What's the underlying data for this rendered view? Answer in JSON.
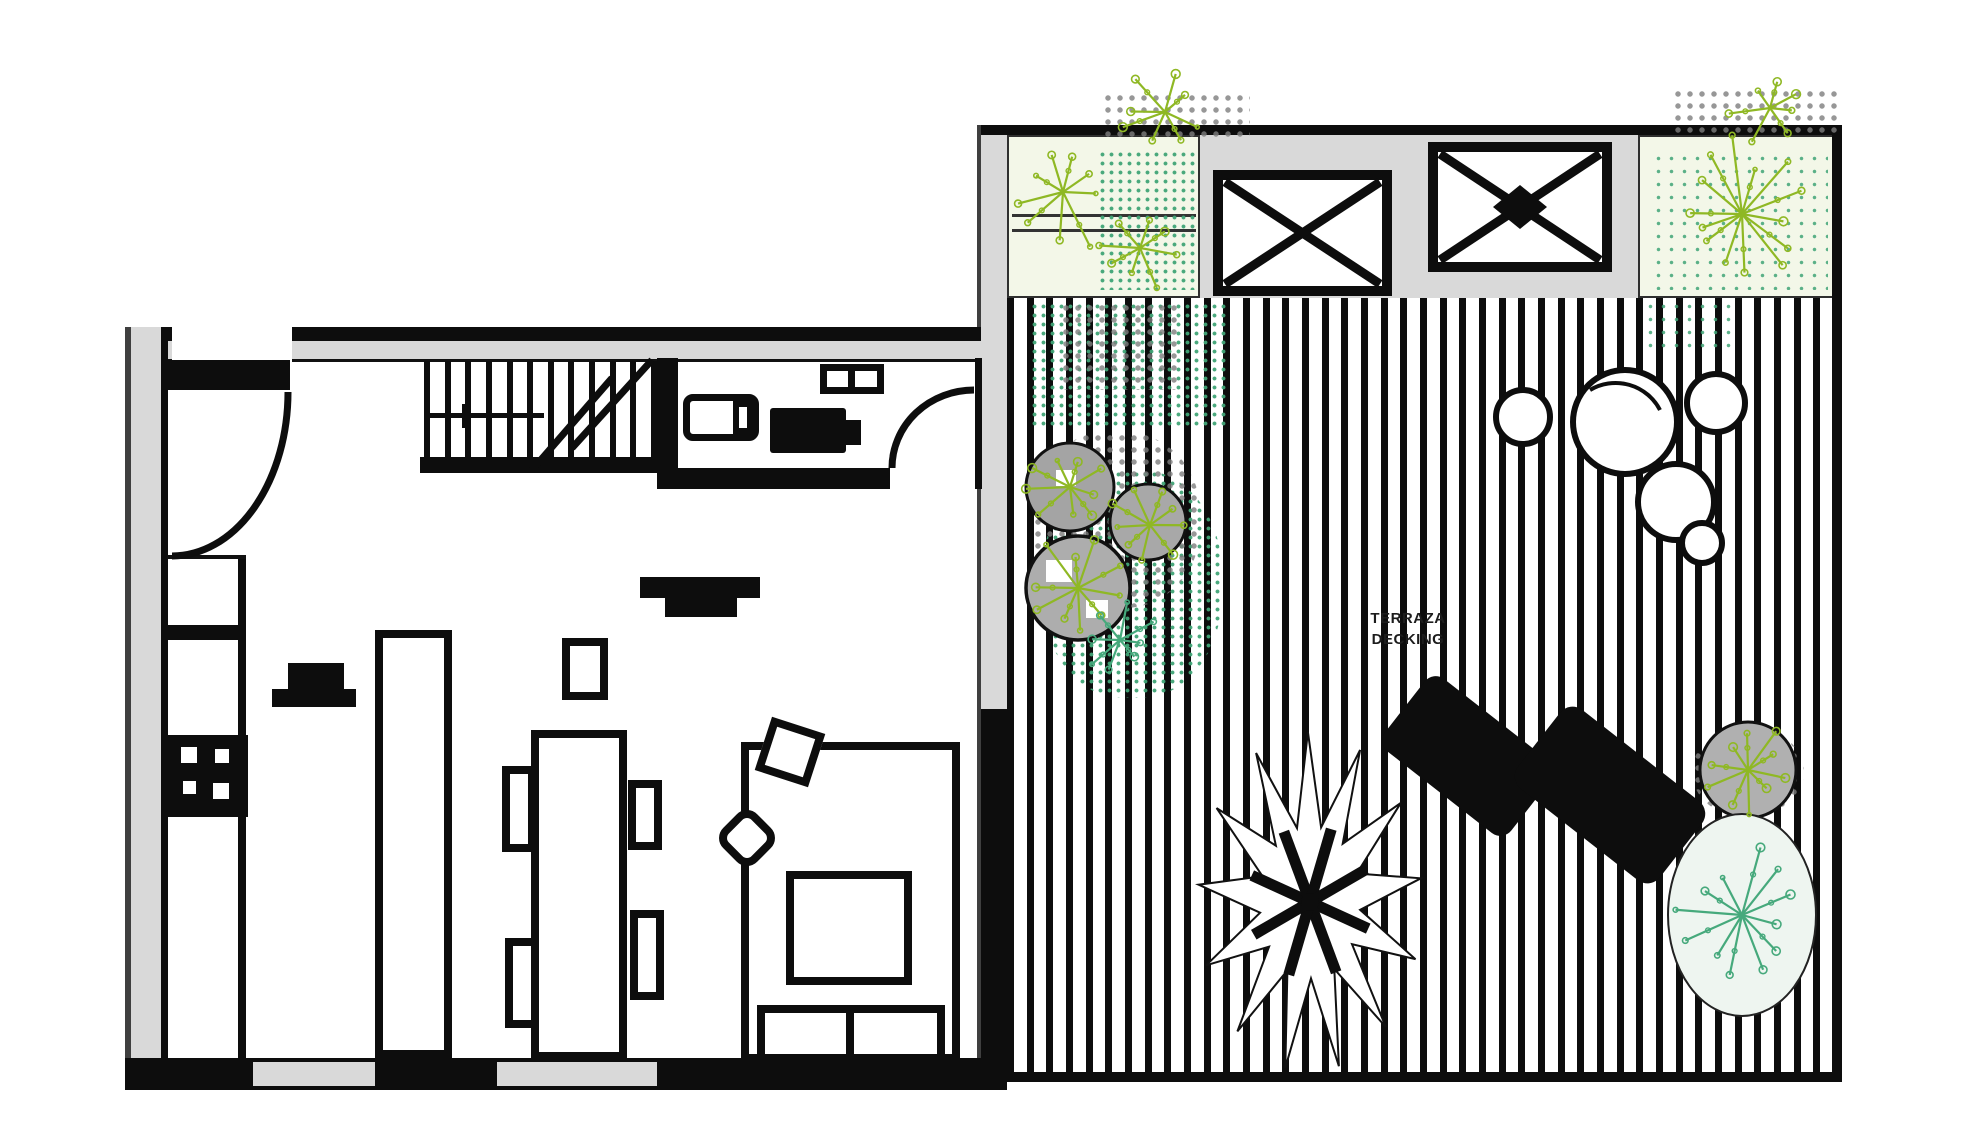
{
  "palette": {
    "ink": "#0d0d0d",
    "wall_gray": "#d9d9d9",
    "planter_bg": "#f3f7e8",
    "leaf_green": "#8fb824",
    "leaf_teal": "#46a97c",
    "shadow_gray": "#ababab"
  },
  "deck": {
    "label": {
      "line1": "TERRAZA",
      "line2": "DECKING"
    },
    "board_count": 43,
    "skylight_count": 2,
    "planter_count": 2,
    "palm": {
      "cx": 1310,
      "cy": 902,
      "points": 13,
      "rx": 112,
      "ry": 170,
      "inner": 0.45,
      "rot": -0.14,
      "spokes": 8,
      "spoke_len": 62
    },
    "stones": [
      [
        1523,
        417,
        27
      ],
      [
        1625,
        422,
        52
      ],
      [
        1716,
        403,
        29
      ],
      [
        1676,
        502,
        38
      ],
      [
        1702,
        543,
        20
      ]
    ],
    "plants": [
      {
        "name": "planter1-fern-a",
        "cx": 1063,
        "cy": 192,
        "r": 62,
        "spokes": 9,
        "color": "#8fb824"
      },
      {
        "name": "planter1-fern-b",
        "cx": 1140,
        "cy": 248,
        "r": 48,
        "spokes": 8,
        "color": "#8fb824"
      },
      {
        "name": "planter2-starburst",
        "cx": 1742,
        "cy": 214,
        "r": 80,
        "spokes": 14,
        "color": "#8fb824"
      },
      {
        "name": "top-spill-a",
        "cx": 1165,
        "cy": 112,
        "r": 46,
        "spokes": 8,
        "color": "#8fb824"
      },
      {
        "name": "top-spill-b",
        "cx": 1770,
        "cy": 108,
        "r": 42,
        "spokes": 7,
        "color": "#8fb824"
      },
      {
        "name": "shrub-a",
        "cx": 1078,
        "cy": 588,
        "r": 55,
        "spokes": 10,
        "color": "#8fb824"
      },
      {
        "name": "shrub-b",
        "cx": 1070,
        "cy": 487,
        "r": 48,
        "spokes": 9,
        "color": "#8fb824"
      },
      {
        "name": "shrub-c",
        "cx": 1150,
        "cy": 525,
        "r": 44,
        "spokes": 9,
        "color": "#8fb824"
      },
      {
        "name": "shrub-d-teal",
        "cx": 1120,
        "cy": 640,
        "r": 40,
        "spokes": 8,
        "color": "#46a97c"
      },
      {
        "name": "bottom-right-shrub-top",
        "cx": 1748,
        "cy": 770,
        "r": 50,
        "spokes": 10,
        "color": "#8fb824"
      },
      {
        "name": "bottom-right-shrub-low",
        "cx": 1742,
        "cy": 915,
        "r": 70,
        "spokes": 12,
        "color": "#46a97c"
      }
    ]
  },
  "house": {
    "stair_tread_count": 12
  }
}
